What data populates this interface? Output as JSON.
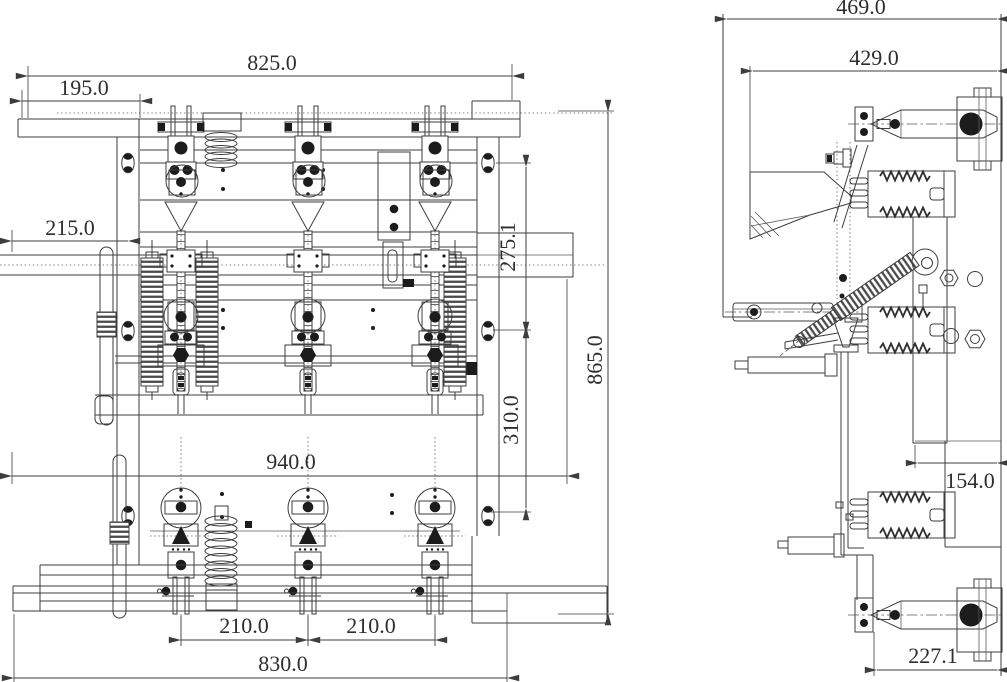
{
  "drawing": {
    "kind": "engineering-dimension-drawing",
    "views": [
      {
        "id": "front",
        "description": "front elevation of three-pole switch assembly"
      },
      {
        "id": "side",
        "description": "side elevation of pole and mechanism"
      }
    ]
  },
  "colors": {
    "background": "#ffffff",
    "line": "#3d3d3d",
    "fill_dark": "#1c1c1c",
    "text": "#2e2e2e"
  },
  "dimensions": {
    "front": {
      "top_width": "825.0",
      "top_left_offset": "195.0",
      "left_offset": "215.0",
      "upper_section_height": "275.1",
      "lower_section_height": "310.0",
      "overall_height": "865.0",
      "mid_width": "940.0",
      "pole_pitch_left": "210.0",
      "pole_pitch_right": "210.0",
      "base_width": "830.0"
    },
    "side": {
      "overall_depth": "469.0",
      "upper_depth": "429.0",
      "frame_depth": "154.0",
      "lower_terminal_depth": "227.1"
    }
  }
}
